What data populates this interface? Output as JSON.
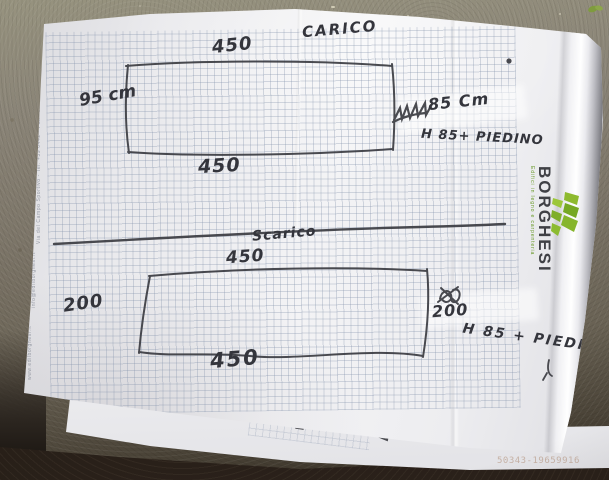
{
  "drawing": {
    "carico": {
      "title": "CARICO",
      "width_top": "450",
      "width_bottom": "450",
      "side_left": "95 cm",
      "side_right": "85 Cm",
      "side_right_scribble": "max",
      "height_note": "H 85+ PIEDINO"
    },
    "scarico": {
      "title": "Scarico",
      "width_top": "450",
      "width_bottom": "450",
      "side_left": "200",
      "side_right": "200",
      "side_right_scribble": "90",
      "height_note": "H 85 + PIEDINO"
    }
  },
  "letterhead": {
    "brand": "BORGHESI",
    "tagline": "Edifici in legno e carpenteria",
    "edge_text_address": "Via del Campo Sportivo - Tel. +39 0442 - Fax +39 0442",
    "edge_text_email": "info@edilborghesi.it",
    "edge_text_web": "www.edilborghesi.it"
  },
  "watermark": "50343-19659916",
  "colors": {
    "ink": "#3b3c42",
    "grid_line": "#8fa0b8",
    "paper": "#ededf0",
    "logo_green": "#7cb228",
    "logo_text": "#3f4045",
    "concrete": "#8a8477",
    "floor_dark": "#20180f"
  }
}
